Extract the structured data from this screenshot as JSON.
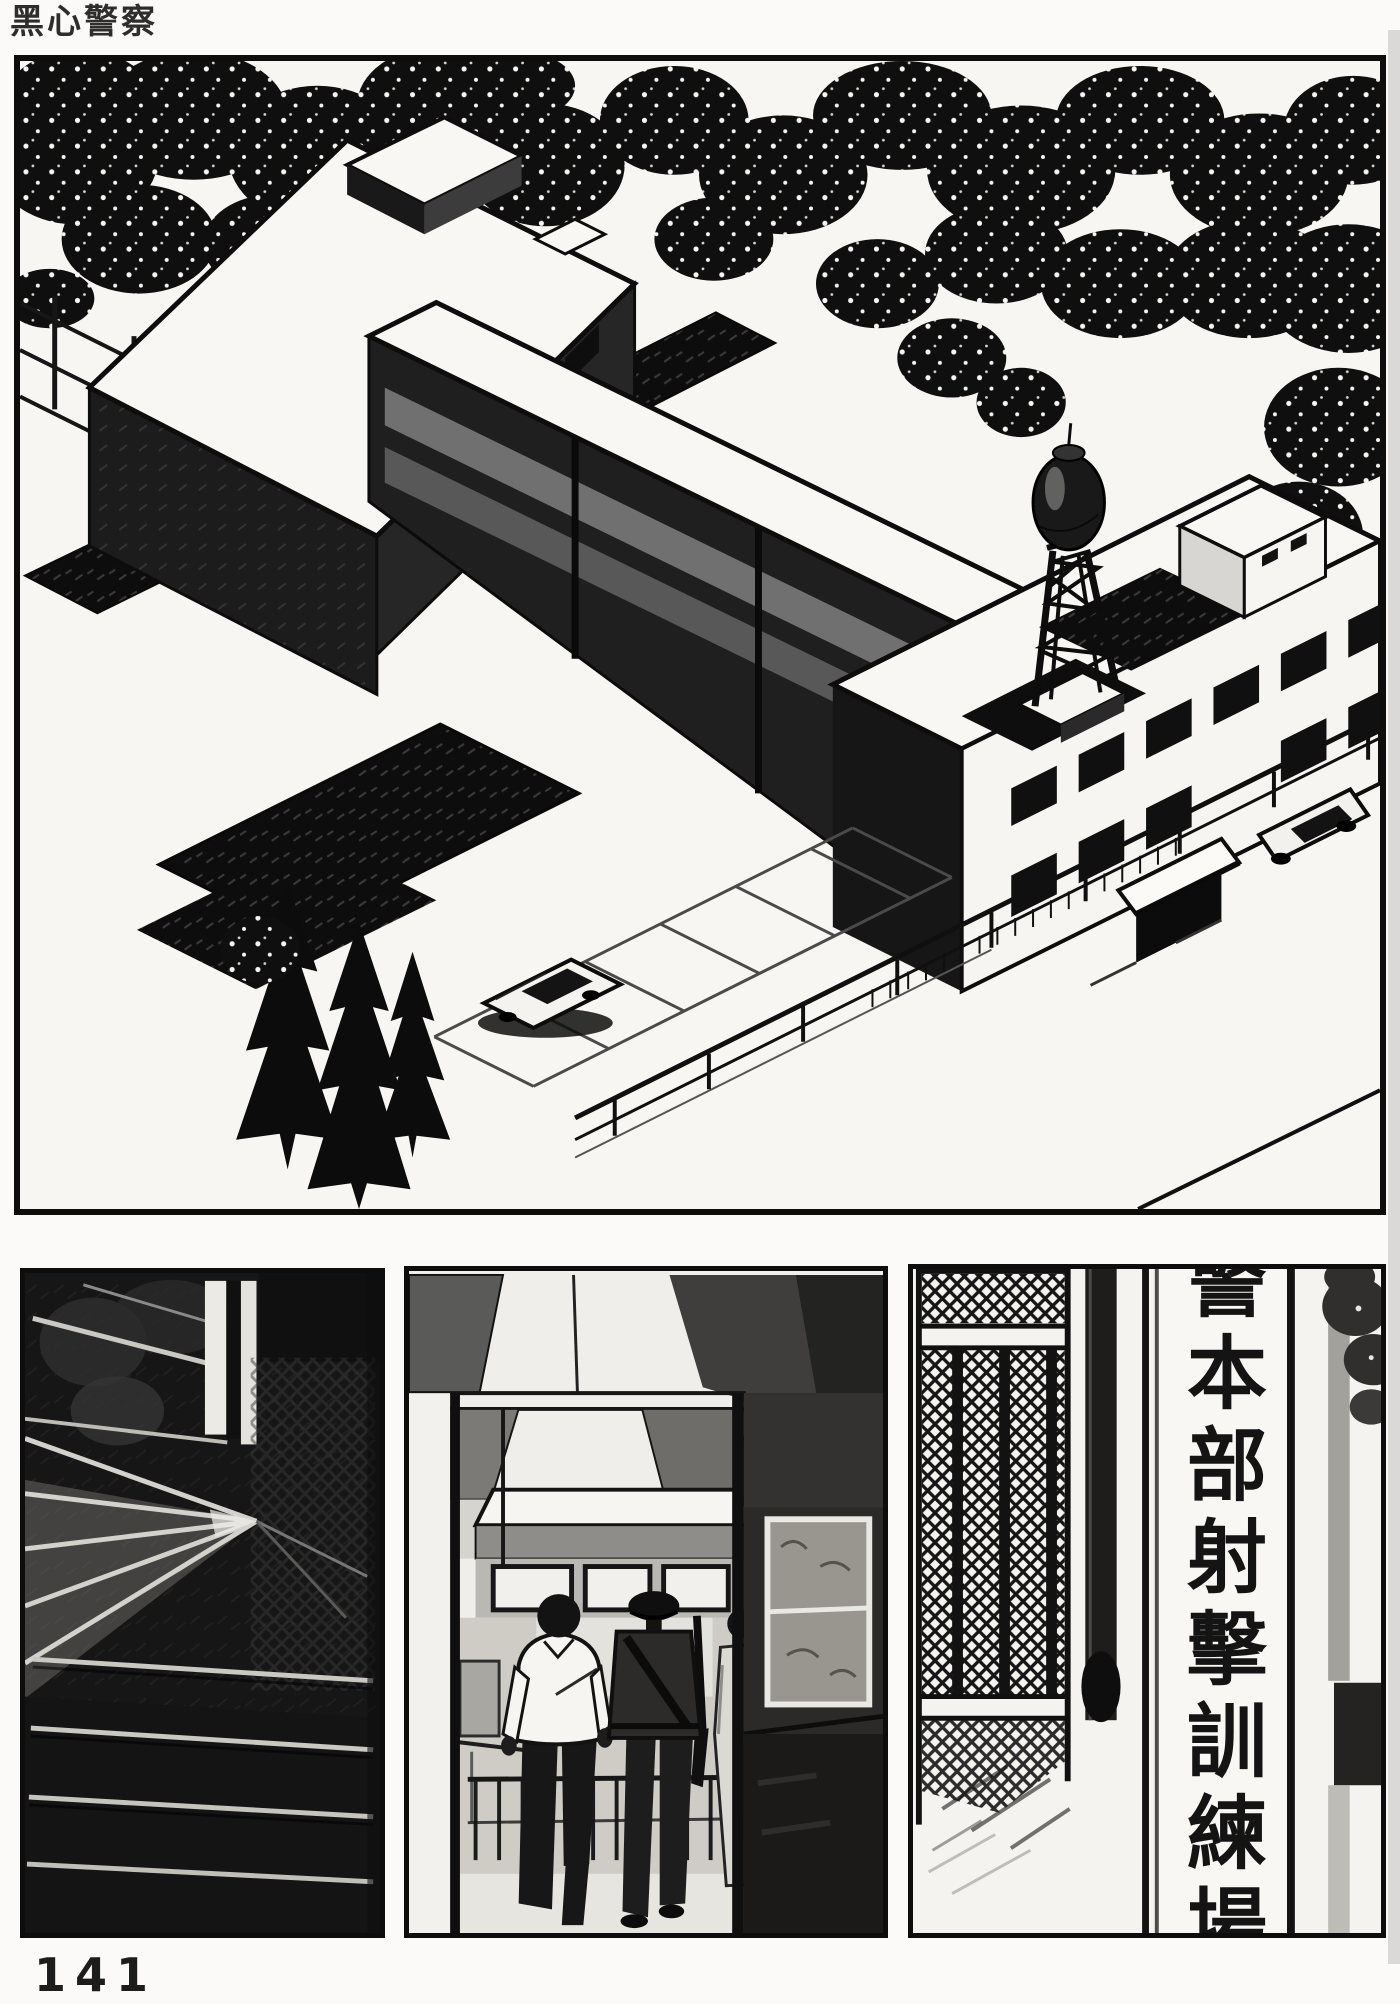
{
  "page": {
    "title": "黑心警察",
    "page_number": "141"
  },
  "panels": {
    "sign": {
      "vertical_text": "警本部射擊訓練場"
    }
  },
  "colors": {
    "ink": "#111111",
    "paper": "#fbfaf8"
  }
}
